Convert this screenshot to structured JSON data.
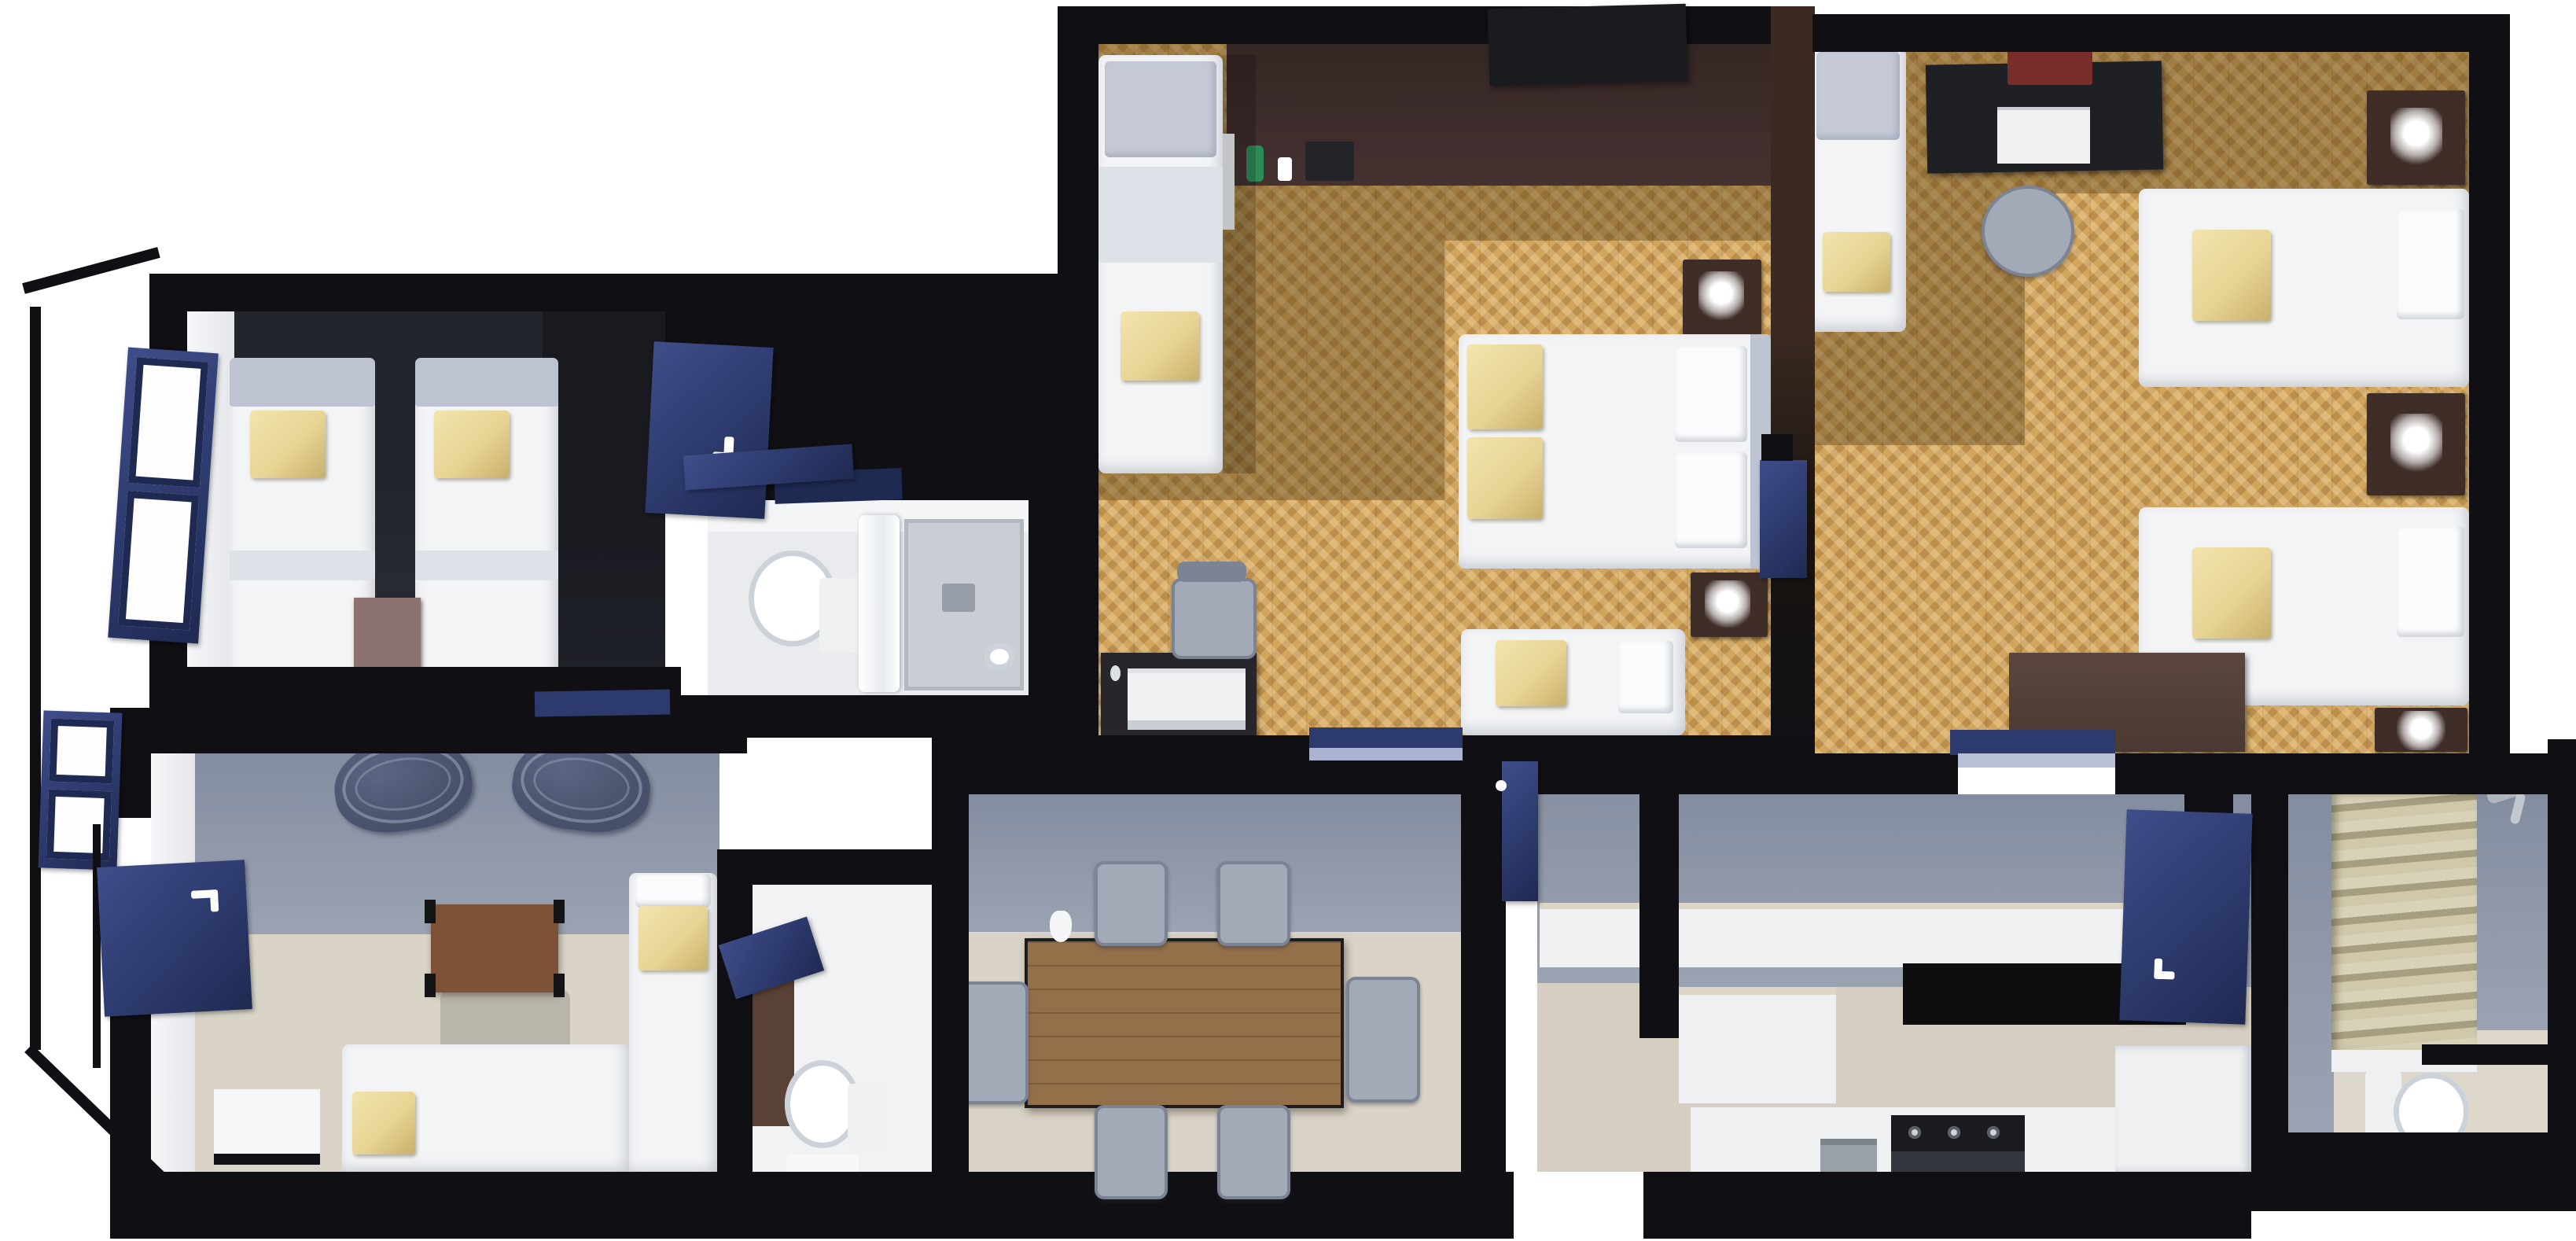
{
  "meta": {
    "title": "3D apartment floor plan — top-down cutaway render",
    "view": "isometric top-down",
    "background": "#ffffff"
  },
  "colors": {
    "wall": "#101014",
    "wall_brown": "#3b2a22",
    "navy": "#2d3a6d",
    "navy_dark": "#1f2a52",
    "navy_light": "#3f4d8a",
    "parquet": "#d2a55c",
    "darkroom": "#23252d",
    "darkroom_floor": "#2d303a",
    "graywall_a": "#848ca0",
    "graywall_b": "#9ba3b2",
    "beige": "#d9d4c7",
    "beige_warm": "#d6cec0",
    "white_bed": "#f3f4f6",
    "headboard": "#bdc3d0",
    "pillow": "#e8d494",
    "pillow_dark": "#c7b06c",
    "night": "#3f2d28",
    "mauve": "#8c7270",
    "table": "#7d5236",
    "dining": "#93704a",
    "console": "#443231",
    "chair": "#a2a9b7",
    "chair_dark": "#7c8494",
    "wire": "#474f6a",
    "stove": "#33363c",
    "tv": "#1a1b1f",
    "curtain_a": "#cfc8ab",
    "curtain_b": "#a59e80",
    "fixture": "#eef0f2",
    "fixture_shadow": "#ccd2d9"
  },
  "rooms": [
    {
      "id": "bedroom-dark",
      "label": "twin bedroom with dark walls",
      "furniture": [
        "single-bed",
        "single-bed",
        "yellow-pillow",
        "yellow-pillow",
        "mauve-nightstand",
        "open-door",
        "window"
      ]
    },
    {
      "id": "wardrobe-nook",
      "label": "wardrobe nook",
      "furniture": [
        "closet-door",
        "wall-shelf"
      ]
    },
    {
      "id": "bathroom-main",
      "label": "bathroom with shower",
      "furniture": [
        "toilet",
        "shower-tray",
        "shower-curtain",
        "door"
      ]
    },
    {
      "id": "bedroom-parquet-double",
      "label": "double bedroom with parquet floor",
      "furniture": [
        "wall-console",
        "tv",
        "minibar-bottles",
        "single-bed",
        "double-bed",
        "lower-bed",
        "nightstand-lamp",
        "nightstand-lamp",
        "computer-desk",
        "printer",
        "desk-chair",
        "door-to-dining"
      ]
    },
    {
      "id": "bedroom-parquet-triple",
      "label": "triple bedroom with parquet floor",
      "furniture": [
        "study-desk",
        "laptop",
        "desk-chair",
        "single-bed",
        "twin-bed",
        "twin-bed",
        "nightstand-lamp",
        "nightstand-lamp",
        "nightstand-lamp",
        "dresser",
        "door"
      ]
    },
    {
      "id": "living-room",
      "label": "living room studio",
      "furniture": [
        "lounge-chair",
        "lounge-chair",
        "coffee-table",
        "single-bed",
        "single-bed",
        "bench",
        "window",
        "entry-door"
      ]
    },
    {
      "id": "wc-small",
      "label": "small WC",
      "furniture": [
        "toilet",
        "vanity",
        "bath-mat",
        "door"
      ]
    },
    {
      "id": "dining-room",
      "label": "dining room",
      "furniture": [
        "dining-table",
        "jug",
        "chair",
        "chair",
        "chair",
        "chair",
        "chair",
        "chair",
        "sliding-door"
      ]
    },
    {
      "id": "hallway",
      "label": "hallway",
      "furniture": []
    },
    {
      "id": "kitchen",
      "label": "kitchen",
      "furniture": [
        "long-counter",
        "island-cabinet",
        "base-cabinets",
        "fridge-cabinet",
        "stove",
        "waste-bin",
        "door"
      ]
    },
    {
      "id": "bathroom-ensuite",
      "label": "shower room",
      "furniture": [
        "shower-curtain",
        "shower-head",
        "shower-step",
        "toilet"
      ]
    }
  ]
}
